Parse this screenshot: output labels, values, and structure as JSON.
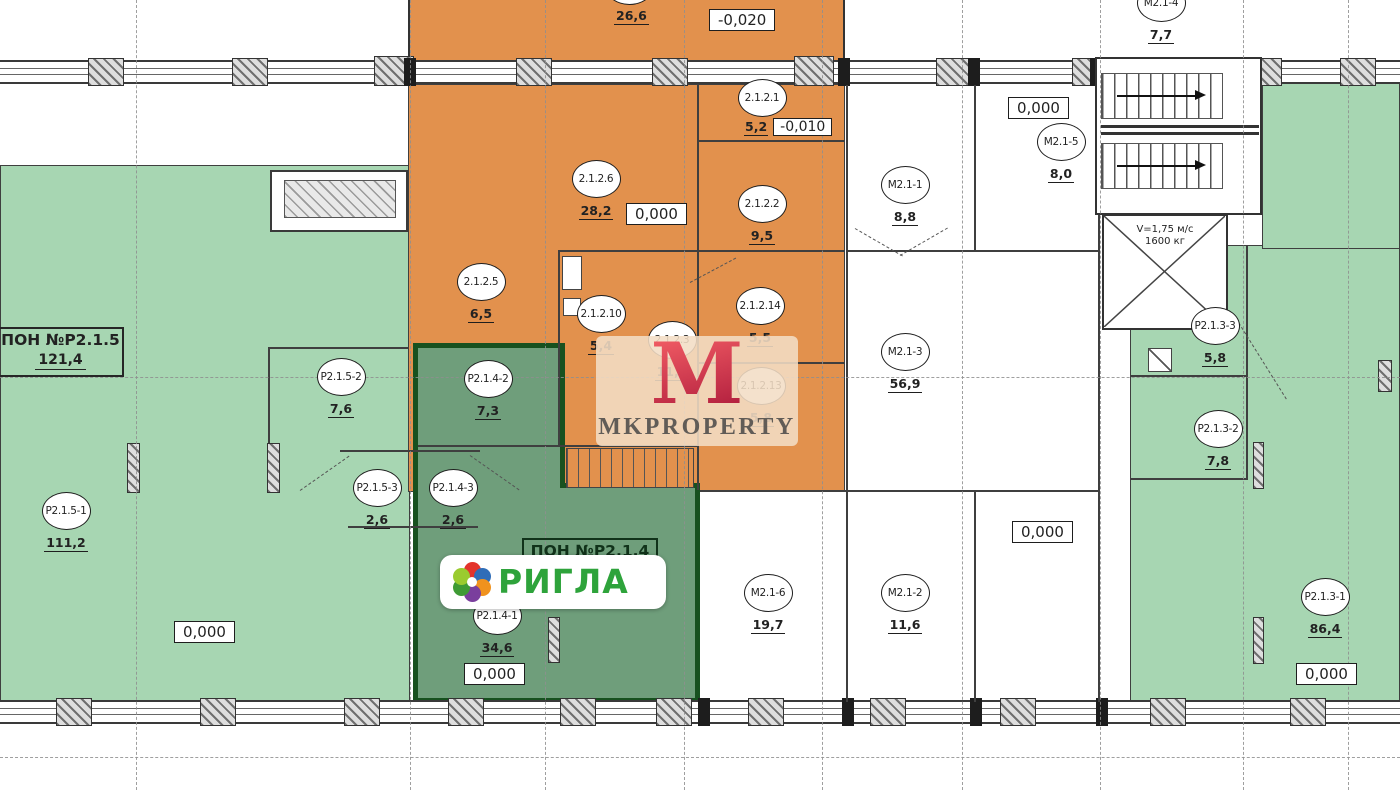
{
  "plan": {
    "units": {
      "pon_p215": {
        "title": "ПОН №Р2.1.5",
        "area": "121,4"
      },
      "pon_p214": {
        "title": "ПОН №Р2.1.4"
      }
    },
    "rooms": {
      "p2151": {
        "code": "Р2.1.5-1",
        "area": "111,2"
      },
      "p2152": {
        "code": "Р2.1.5-2",
        "area": "7,6"
      },
      "p2153": {
        "code": "Р2.1.5-3",
        "area": "2,6"
      },
      "p2141": {
        "code": "Р2.1.4-1",
        "area": "34,6"
      },
      "p2142": {
        "code": "Р2.1.4-2",
        "area": "7,3"
      },
      "p2143": {
        "code": "Р2.1.4-3",
        "area": "2,6"
      },
      "r2126": {
        "code": "2.1.2.6",
        "area": "28,2"
      },
      "r2125": {
        "code": "2.1.2.5",
        "area": "6,5"
      },
      "r21210": {
        "code": "2.1.2.10",
        "area": "5,4"
      },
      "r2123": {
        "code": "2.1.2.3",
        "area": "11,1"
      },
      "r2121": {
        "code": "2.1.2.1",
        "area": "5,2"
      },
      "r2122": {
        "code": "2.1.2.2",
        "area": "9,5"
      },
      "r21214": {
        "code": "2.1.2.14",
        "area": "5,5"
      },
      "r21213": {
        "code": "2.1.2.13",
        "area": "5,8"
      },
      "r_top": {
        "code": "",
        "area": "26,6"
      },
      "m211": {
        "code": "М2.1-1",
        "area": "8,8"
      },
      "m215": {
        "code": "М2.1-5",
        "area": "8,0"
      },
      "m213": {
        "code": "М2.1-3",
        "area": "56,9"
      },
      "m216": {
        "code": "М2.1-6",
        "area": "19,7"
      },
      "m212": {
        "code": "М2.1-2",
        "area": "11,6"
      },
      "m214": {
        "code": "М2.1-4",
        "area": "7,7"
      },
      "p2133": {
        "code": "Р2.1.3-3",
        "area": "5,8"
      },
      "p2132": {
        "code": "Р2.1.3-2",
        "area": "7,8"
      },
      "p2131": {
        "code": "Р2.1.3-1",
        "area": "86,4"
      }
    },
    "levels": {
      "zero": "0,000",
      "minus10": "-0,010",
      "minus20": "-0,020"
    },
    "elevator": {
      "speed": "V=1,75 м/с",
      "capacity": "1600 кг"
    }
  },
  "branding": {
    "tenant_logo": "РИГЛА",
    "watermark_letter": "М",
    "watermark_text": "MKPROPERTY"
  },
  "colors": {
    "orange": "#e2914d",
    "green": "#a7d6b2",
    "unit_green": "#6f9e7b",
    "unit_border": "#17511f",
    "logo_green": "#2ea33b",
    "watermark_red": "#c8203f",
    "watermark_beige": "#f3ddc5"
  }
}
